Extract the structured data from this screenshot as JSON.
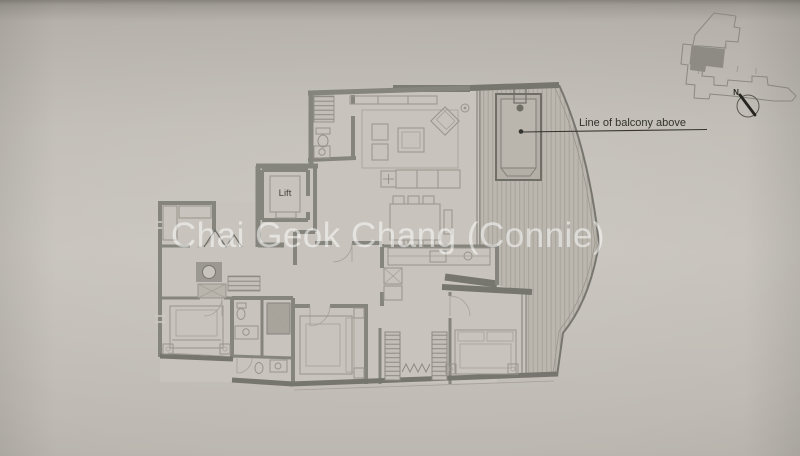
{
  "photo": {
    "watermark": "Chai Geok Chang (Connie)"
  },
  "plan": {
    "lift_label": "Lift",
    "balcony_annotation": "Line of balcony above",
    "compass_label": "N"
  },
  "colors": {
    "paper": "#c4c0b9",
    "paper_dark": "#a7a39c",
    "wall": "#85847d",
    "wall_dark": "#76756e",
    "furniture_line": "#97948c",
    "deck_fill": "#bbb7af",
    "deck_line": "#a7a39b",
    "room_fill": "#c8c4bd",
    "keyplan_unit_fill": "#8d8b83",
    "ink": "#33322e",
    "watermark": "rgba(255,255,255,0.52)"
  }
}
